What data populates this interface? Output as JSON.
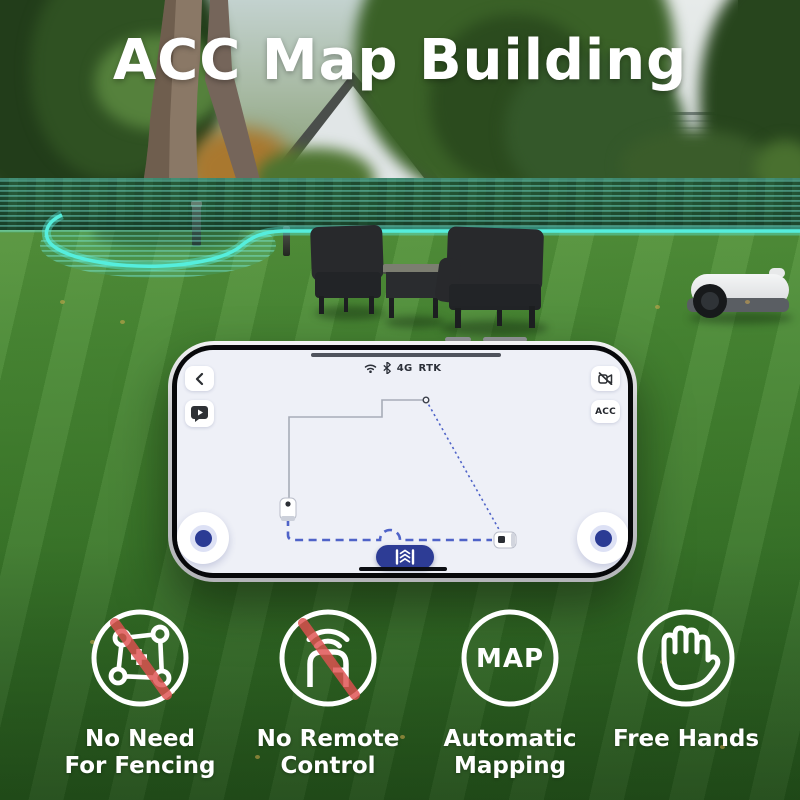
{
  "title": "ACC Map Building",
  "phone": {
    "status": {
      "network_label": "4G",
      "rtk_label": "RTK"
    },
    "acc_button_label": "ACC"
  },
  "features": [
    {
      "icon": "no-fencing-icon",
      "line1": "No Need",
      "line2": "For Fencing"
    },
    {
      "icon": "no-remote-icon",
      "line1": "No Remote",
      "line2": "Control"
    },
    {
      "icon": "map-icon",
      "map_text": "MAP",
      "line1": "Automatic",
      "line2": "Mapping"
    },
    {
      "icon": "free-hands-icon",
      "line1": "Free Hands",
      "line2": ""
    }
  ],
  "colors": {
    "virtual_fence_teal": "#52eadb",
    "path_blue": "#4f63c8",
    "drive_button_blue": "#2d3c95",
    "prohibit_red": "#df5050",
    "text_white": "#ffffff"
  }
}
